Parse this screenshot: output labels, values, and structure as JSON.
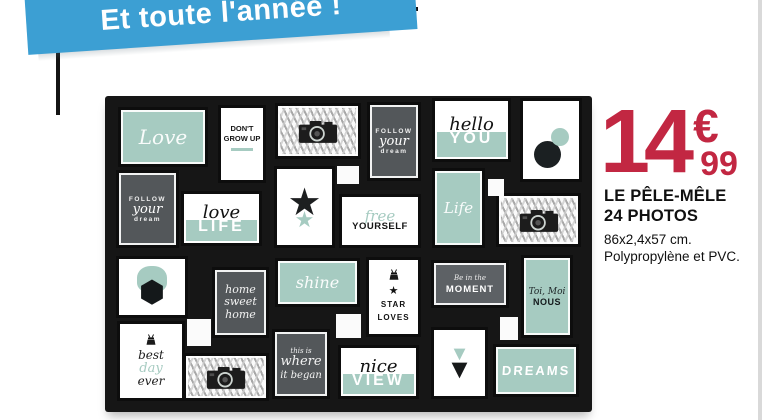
{
  "banner": {
    "label": "Et toute l'année !",
    "bg": "#3c9fd3"
  },
  "price": {
    "amount": "14",
    "currency": "€",
    "cents": "99",
    "color": "#c22742"
  },
  "product": {
    "name_line1": "LE PÊLE-MÊLE",
    "name_line2": "24 PHOTOS",
    "dimensions": "86x2,4x57 cm.",
    "material": "Polypropylène et PVC."
  },
  "collage": {
    "colors": {
      "frame": "#161616",
      "mint": "#a6cbc1",
      "dark": "#53575a",
      "gray": "#5d6165"
    },
    "frames": [
      {
        "name": "love",
        "kind": "mint-script",
        "x": 13,
        "y": 11,
        "w": 90,
        "h": 60,
        "text": "Love",
        "size": 20
      },
      {
        "name": "dont-grow-up",
        "kind": "caps-card",
        "x": 113,
        "y": 9,
        "w": 48,
        "h": 78,
        "lines": [
          "DON'T",
          "GROW UP"
        ]
      },
      {
        "name": "camera-print-1",
        "kind": "camera",
        "icon": "camera-icon",
        "x": 170,
        "y": 7,
        "w": 86,
        "h": 56
      },
      {
        "name": "follow-your-dream-1",
        "kind": "dark-follow",
        "x": 262,
        "y": 6,
        "w": 54,
        "h": 79,
        "lines": [
          "FOLLOW",
          "your",
          "dream"
        ]
      },
      {
        "name": "hello-you",
        "kind": "split",
        "x": 327,
        "y": 2,
        "w": 79,
        "h": 64,
        "script": "hello",
        "caps": "YOU"
      },
      {
        "name": "two-dots",
        "kind": "dots",
        "icon": "circles-icon",
        "x": 415,
        "y": 2,
        "w": 62,
        "h": 84
      },
      {
        "name": "follow-your-dream-2",
        "kind": "dark-follow",
        "x": 11,
        "y": 74,
        "w": 63,
        "h": 78,
        "lines": [
          "FOLLOW",
          "your",
          "dream"
        ]
      },
      {
        "name": "love-life",
        "kind": "split",
        "x": 76,
        "y": 95,
        "w": 81,
        "h": 55,
        "script": "love",
        "caps": "LIFE"
      },
      {
        "name": "double-star",
        "kind": "star",
        "icon": "star-icon",
        "x": 169,
        "y": 70,
        "w": 61,
        "h": 82
      },
      {
        "name": "free-yourself",
        "kind": "script-caps-card",
        "x": 234,
        "y": 98,
        "w": 82,
        "h": 54,
        "script": "free",
        "caps": "YOURSELF"
      },
      {
        "name": "life",
        "kind": "mint-script",
        "x": 327,
        "y": 72,
        "w": 53,
        "h": 80,
        "text": "Life",
        "size": 15
      },
      {
        "name": "camera-print-2",
        "kind": "camera",
        "icon": "camera-icon",
        "x": 391,
        "y": 97,
        "w": 85,
        "h": 54
      },
      {
        "name": "geo-shapes",
        "kind": "shapes",
        "icon": "hexagon-icon",
        "x": 11,
        "y": 160,
        "w": 72,
        "h": 62
      },
      {
        "name": "home-sweet-home",
        "kind": "dark-script3",
        "x": 107,
        "y": 171,
        "w": 57,
        "h": 71,
        "lines": [
          "home",
          "sweet",
          "home"
        ]
      },
      {
        "name": "shine",
        "kind": "mint-script",
        "x": 170,
        "y": 162,
        "w": 85,
        "h": 49,
        "text": "shine",
        "size": 16
      },
      {
        "name": "star-loves",
        "kind": "clip-star",
        "icon": "binder-clip-icon",
        "x": 261,
        "y": 161,
        "w": 55,
        "h": 80,
        "lines": [
          "STAR",
          "LOVES"
        ]
      },
      {
        "name": "be-in-the-moment",
        "kind": "moment",
        "x": 326,
        "y": 164,
        "w": 78,
        "h": 48,
        "small": "Be in the",
        "caps": "MOMENT"
      },
      {
        "name": "toi-moi-nous",
        "kind": "mint-caption",
        "x": 416,
        "y": 159,
        "w": 52,
        "h": 83,
        "small": "Toi, Moi",
        "caps": "NOUS"
      },
      {
        "name": "best-day-ever",
        "kind": "clip-script",
        "icon": "binder-clip-icon",
        "x": 12,
        "y": 225,
        "w": 68,
        "h": 80,
        "lines": [
          "best",
          "day",
          "ever"
        ]
      },
      {
        "name": "camera-print-3",
        "kind": "camera",
        "icon": "camera-icon",
        "x": 78,
        "y": 257,
        "w": 86,
        "h": 48
      },
      {
        "name": "where-it-began",
        "kind": "dark-script3",
        "x": 167,
        "y": 233,
        "w": 58,
        "h": 70,
        "lines": [
          "this is",
          "where",
          "it began"
        ]
      },
      {
        "name": "nice-view",
        "kind": "split",
        "x": 233,
        "y": 249,
        "w": 81,
        "h": 54,
        "script": "nice",
        "caps": "VIEW"
      },
      {
        "name": "double-triangle",
        "kind": "triangles",
        "icon": "triangle-down-icon",
        "x": 326,
        "y": 231,
        "w": 57,
        "h": 72
      },
      {
        "name": "dreams",
        "kind": "mint-caps",
        "x": 388,
        "y": 248,
        "w": 86,
        "h": 53,
        "text": "DREAMS"
      }
    ],
    "fillers": [
      {
        "x": 232,
        "y": 70,
        "w": 22,
        "h": 18
      },
      {
        "x": 383,
        "y": 83,
        "w": 16,
        "h": 17
      },
      {
        "x": 82,
        "y": 223,
        "w": 24,
        "h": 27
      },
      {
        "x": 231,
        "y": 218,
        "w": 25,
        "h": 24
      },
      {
        "x": 395,
        "y": 221,
        "w": 18,
        "h": 23
      }
    ]
  }
}
